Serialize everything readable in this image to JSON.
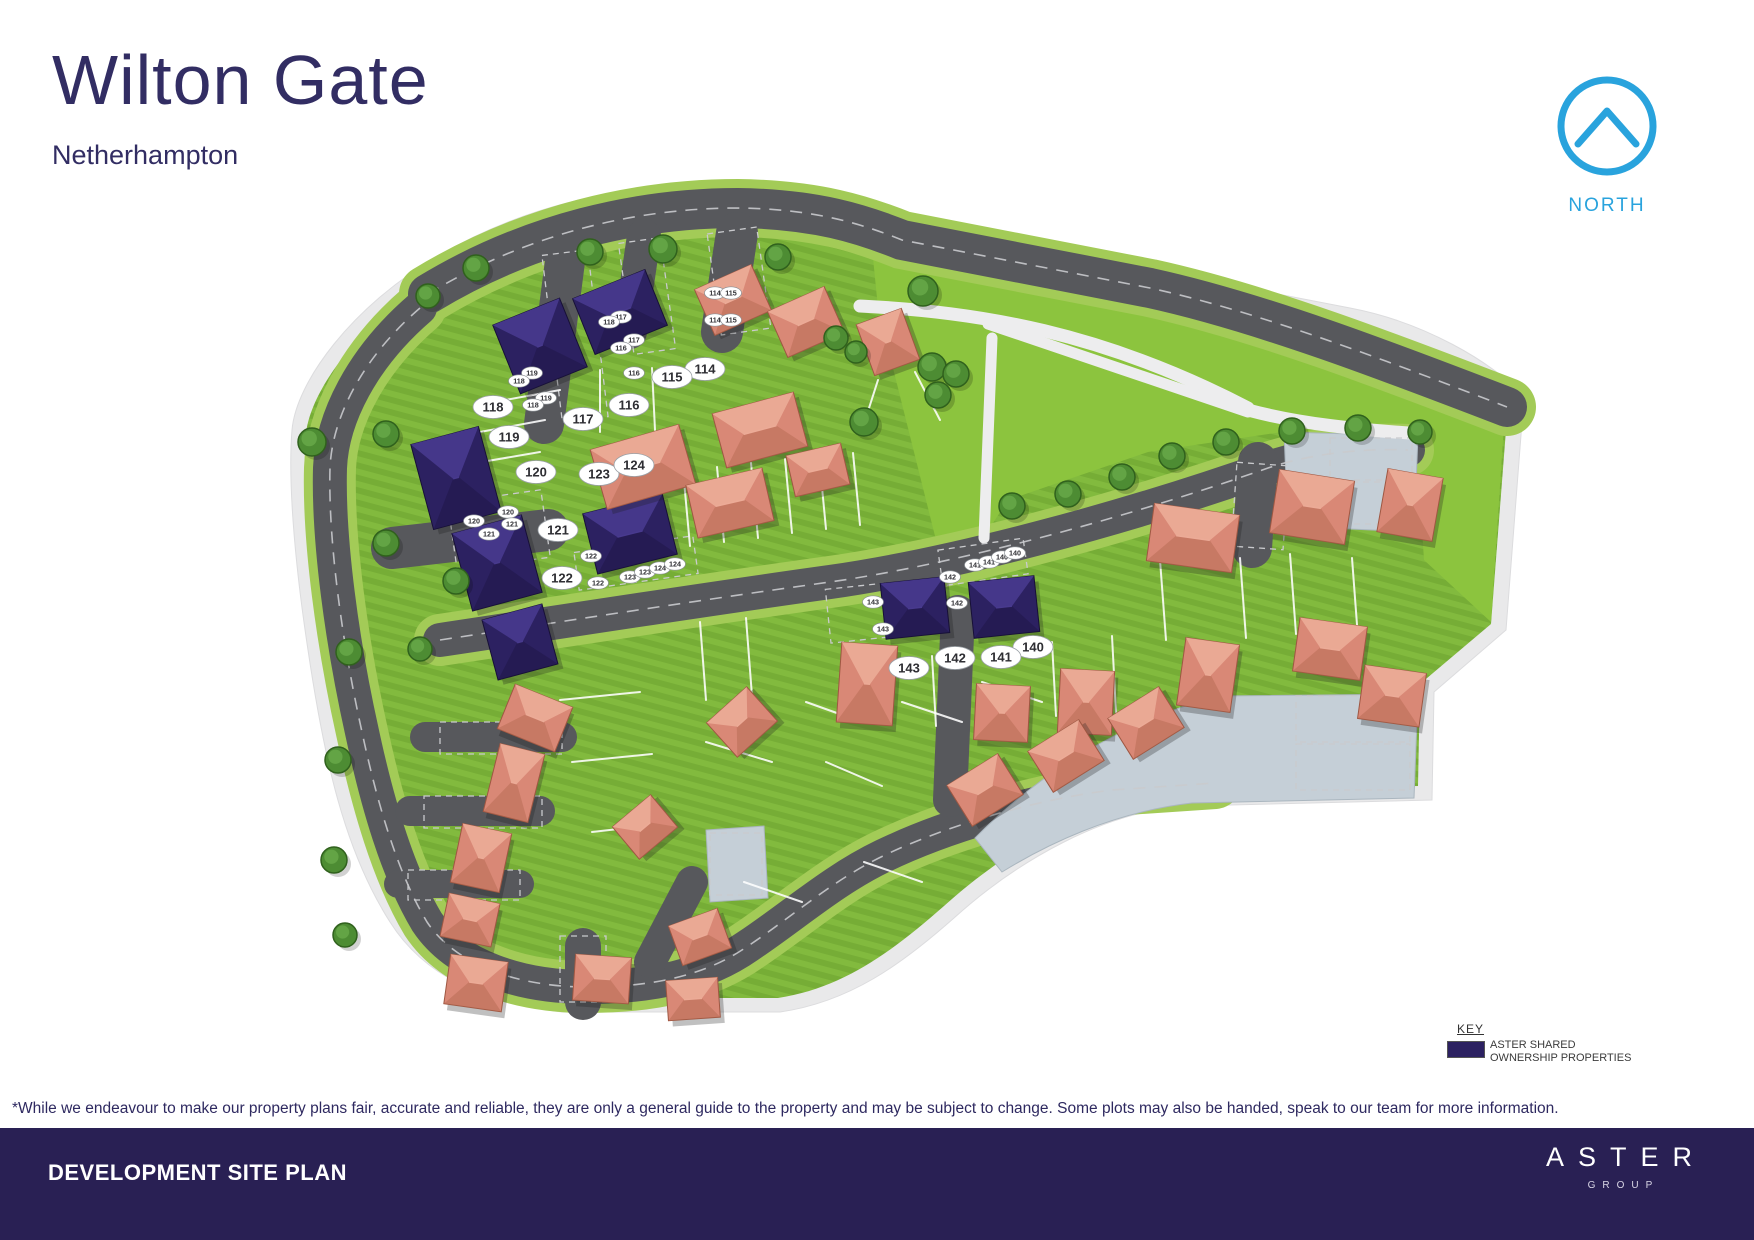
{
  "header": {
    "title": "Wilton Gate",
    "subtitle": "Netherhampton"
  },
  "north": {
    "label": "NORTH",
    "color": "#29a3dd"
  },
  "key": {
    "title": "KEY",
    "line1": "ASTER SHARED",
    "line2": "OWNERSHIP PROPERTIES",
    "swatch_color": "#2c2161"
  },
  "disclaimer": "*While we endeavour to make our property plans fair, accurate and reliable, they are only a general guide to the property and may be subject to change. Some plots may also be handed, speak to our team for more information.",
  "footer": {
    "title": "DEVELOPMENT SITE PLAN",
    "brand": "ASTER",
    "brand_sub": "GROUP"
  },
  "map": {
    "colors": {
      "band": "#e9e9ea",
      "band_line": "#dcdcde",
      "road": "#57585c",
      "verge": "#a3cb57",
      "dash": "#c9cacd",
      "paving": "#c5cfd7",
      "paving_line": "#aab6bf",
      "path": "#ededee",
      "grass_a": "#76ad36",
      "grass_b": "#82ba3e",
      "open": "#8cc43e",
      "shared": {
        "base": "#2c2161",
        "light": "#483a8e",
        "dark": "#1e1545",
        "line": "#171036"
      },
      "private": {
        "base": "#d98876",
        "light": "#ecab97",
        "dark": "#b66a52",
        "line": "#9e5742"
      },
      "tree": "#4d8c33",
      "tree_line": "#30611d",
      "tree_hi": "#66a647",
      "pill_text": "#2e2e33"
    },
    "site_outline": "M 438,256 C 520,208 612,186 700,186 C 780,187 836,200 884,218 L 1350,308 C 1424,322 1492,362 1524,396 L 1506,630 L 1434,692 L 1432,800 L 1190,806 C 1104,810 1016,862 954,918 C 902,964 850,1002 780,1012 L 562,1012 C 482,1002 424,976 390,922 C 344,850 324,758 308,650 C 294,558 288,478 292,430 C 296,382 352,306 438,256 Z",
    "inner_green": "M 452,268 C 528,222 616,200 700,200 C 776,201 830,214 878,232 L 1344,322 C 1412,335 1476,372 1508,404 L 1491,624 L 1420,684 L 1418,786 L 1188,792 C 1096,796 1008,848 944,906 C 894,950 844,988 778,998 L 566,998 C 492,989 434,964 402,914 C 358,844 338,754 322,648 C 308,556 302,480 306,434 C 310,390 364,314 452,268 Z",
    "open_space": "M 872,248 L 1348,336 L 1505,410 L 1491,622 L 1424,560 L 1416,436 L 1282,432 L 1148,452 L 1008,500 L 982,540 L 938,548 L 878,308 Z",
    "roads": [
      {
        "d": "M 428,294 C 530,232 640,208 738,208 C 816,209 862,224 902,240 L 1150,288 C 1260,312 1390,362 1507,407",
        "w": 40,
        "verge": true,
        "dash": true
      },
      {
        "d": "M 440,640 C 560,622 700,600 830,582 C 950,565 1120,520 1268,468 C 1310,454 1360,448 1408,450",
        "w": 34,
        "verge": true,
        "dash": true
      },
      {
        "d": "M 420,308 C 362,358 332,418 330,468 C 328,540 342,642 362,732 C 377,802 397,872 427,922 C 457,967 522,987 587,987 C 652,987 705,976 748,946 C 793,916 833,880 883,856 C 943,827 1032,800 1112,790 L 1215,783",
        "w": 34,
        "verge": true,
        "dash": true
      },
      {
        "d": "M 568,238 L 544,424",
        "w": 40
      },
      {
        "d": "M 644,236 L 630,332",
        "w": 34
      },
      {
        "d": "M 737,233 L 722,332",
        "w": 42
      },
      {
        "d": "M 392,548 L 548,530",
        "w": 42
      },
      {
        "d": "M 958,612 L 950,800",
        "w": 34
      },
      {
        "d": "M 650,962 L 692,882",
        "w": 32
      },
      {
        "d": "M 1258,462 L 1252,548",
        "w": 40
      },
      {
        "d": "M 425,737 L 562,737",
        "w": 30
      },
      {
        "d": "M 410,811 L 540,811",
        "w": 30
      },
      {
        "d": "M 398,884 L 520,884",
        "w": 28
      },
      {
        "d": "M 583,946 L 583,1002",
        "w": 36
      }
    ],
    "courts": [
      "M 1284,432 L 1418,436 L 1414,532 L 1288,526 Z",
      "M 975,838 C 1040,772 1122,722 1218,696 L 1418,694 L 1414,798 L 1192,803 C 1112,812 1044,846 1002,872 Z",
      "M 706,830 L 764,826 L 768,898 L 710,902 Z"
    ],
    "paths": [
      {
        "d": "M 860,306 C 980,312 1102,332 1248,408",
        "w": 13
      },
      {
        "d": "M 988,324 C 1070,352 1166,384 1248,412",
        "w": 11
      },
      {
        "d": "M 992,338 L 984,538",
        "w": 11
      },
      {
        "d": "M 1248,410 C 1300,424 1360,430 1424,434",
        "w": 13
      }
    ],
    "bays": [
      [
        552,
        252,
        46,
        168,
        -7
      ],
      [
        626,
        240,
        42,
        112,
        -8
      ],
      [
        714,
        230,
        50,
        102,
        -8
      ],
      [
        452,
        496,
        94,
        68,
        -8
      ],
      [
        440,
        722,
        122,
        32,
        0
      ],
      [
        424,
        796,
        118,
        32,
        0
      ],
      [
        408,
        870,
        112,
        30,
        0
      ],
      [
        560,
        936,
        46,
        66,
        0
      ],
      [
        576,
        544,
        120,
        38,
        -8
      ],
      [
        940,
        544,
        86,
        36,
        -8
      ],
      [
        828,
        586,
        62,
        54,
        -6
      ],
      [
        1234,
        464,
        52,
        84,
        4
      ],
      [
        1296,
        696,
        114,
        46,
        0
      ],
      [
        1296,
        744,
        114,
        46,
        0
      ],
      [
        1330,
        438,
        82,
        42,
        0
      ],
      [
        1330,
        482,
        82,
        42,
        0
      ],
      [
        710,
        833,
        52,
        62,
        0
      ]
    ],
    "fences": [
      [
        690,
        546,
        683,
        470
      ],
      [
        724,
        542,
        717,
        467
      ],
      [
        758,
        538,
        751,
        463
      ],
      [
        792,
        533,
        785,
        459
      ],
      [
        826,
        529,
        819,
        456
      ],
      [
        860,
        525,
        853,
        453
      ],
      [
        700,
        622,
        706,
        700
      ],
      [
        746,
        618,
        752,
        696
      ],
      [
        882,
        652,
        886,
        722
      ],
      [
        932,
        656,
        936,
        726
      ],
      [
        1052,
        642,
        1056,
        716
      ],
      [
        1112,
        636,
        1116,
        712
      ],
      [
        480,
        432,
        545,
        420
      ],
      [
        470,
        464,
        540,
        452
      ],
      [
        505,
        400,
        560,
        390
      ],
      [
        600,
        432,
        600,
        370
      ],
      [
        655,
        430,
        652,
        368
      ],
      [
        1160,
        560,
        1166,
        640
      ],
      [
        1240,
        558,
        1246,
        638
      ],
      [
        1290,
        554,
        1296,
        634
      ],
      [
        1352,
        558,
        1358,
        638
      ],
      [
        560,
        700,
        640,
        692
      ],
      [
        572,
        762,
        652,
        754
      ],
      [
        592,
        832,
        662,
        824
      ],
      [
        706,
        742,
        772,
        762
      ],
      [
        806,
        702,
        862,
        722
      ],
      [
        902,
        702,
        962,
        722
      ],
      [
        826,
        762,
        882,
        786
      ],
      [
        744,
        882,
        802,
        902
      ],
      [
        864,
        862,
        922,
        882
      ],
      [
        982,
        682,
        1042,
        702
      ],
      [
        878,
        380,
        862,
        430
      ],
      [
        915,
        372,
        940,
        420
      ]
    ],
    "houses": [
      {
        "x": 620,
        "y": 312,
        "w": 78,
        "h": 60,
        "r": -22,
        "t": "shared"
      },
      {
        "x": 540,
        "y": 346,
        "w": 72,
        "h": 74,
        "r": -22,
        "t": "shared"
      },
      {
        "x": 456,
        "y": 478,
        "w": 70,
        "h": 88,
        "r": -15,
        "t": "shared"
      },
      {
        "x": 497,
        "y": 563,
        "w": 72,
        "h": 80,
        "r": -15,
        "t": "shared"
      },
      {
        "x": 520,
        "y": 642,
        "w": 62,
        "h": 62,
        "r": -15,
        "t": "shared"
      },
      {
        "x": 630,
        "y": 534,
        "w": 82,
        "h": 62,
        "r": -14,
        "t": "shared"
      },
      {
        "x": 915,
        "y": 608,
        "w": 64,
        "h": 56,
        "r": -6,
        "t": "shared"
      },
      {
        "x": 1004,
        "y": 607,
        "w": 66,
        "h": 56,
        "r": -6,
        "t": "shared"
      },
      {
        "x": 733,
        "y": 300,
        "w": 62,
        "h": 50,
        "r": -24,
        "t": "private"
      },
      {
        "x": 806,
        "y": 322,
        "w": 62,
        "h": 50,
        "r": -24,
        "t": "private"
      },
      {
        "x": 888,
        "y": 342,
        "w": 48,
        "h": 54,
        "r": -20,
        "t": "private"
      },
      {
        "x": 643,
        "y": 467,
        "w": 92,
        "h": 62,
        "r": -16,
        "t": "private"
      },
      {
        "x": 760,
        "y": 430,
        "w": 84,
        "h": 56,
        "r": -15,
        "t": "private"
      },
      {
        "x": 730,
        "y": 503,
        "w": 78,
        "h": 54,
        "r": -13,
        "t": "private"
      },
      {
        "x": 818,
        "y": 470,
        "w": 56,
        "h": 42,
        "r": -13,
        "t": "private"
      },
      {
        "x": 1193,
        "y": 538,
        "w": 86,
        "h": 58,
        "r": 8,
        "t": "private"
      },
      {
        "x": 1312,
        "y": 507,
        "w": 76,
        "h": 64,
        "r": 9,
        "t": "private"
      },
      {
        "x": 1410,
        "y": 505,
        "w": 56,
        "h": 64,
        "r": 10,
        "t": "private"
      },
      {
        "x": 1208,
        "y": 675,
        "w": 54,
        "h": 68,
        "r": 8,
        "t": "private"
      },
      {
        "x": 1330,
        "y": 649,
        "w": 68,
        "h": 54,
        "r": 8,
        "t": "private"
      },
      {
        "x": 1392,
        "y": 696,
        "w": 62,
        "h": 54,
        "r": 8,
        "t": "private"
      },
      {
        "x": 867,
        "y": 684,
        "w": 56,
        "h": 80,
        "r": 4,
        "t": "private"
      },
      {
        "x": 1002,
        "y": 713,
        "w": 54,
        "h": 56,
        "r": 3,
        "t": "private"
      },
      {
        "x": 1086,
        "y": 702,
        "w": 54,
        "h": 64,
        "r": 3,
        "t": "private"
      },
      {
        "x": 985,
        "y": 790,
        "w": 60,
        "h": 48,
        "r": -32,
        "t": "private"
      },
      {
        "x": 1066,
        "y": 756,
        "w": 60,
        "h": 48,
        "r": -32,
        "t": "private"
      },
      {
        "x": 1146,
        "y": 723,
        "w": 60,
        "h": 48,
        "r": -32,
        "t": "private"
      },
      {
        "x": 535,
        "y": 718,
        "w": 62,
        "h": 48,
        "r": 22,
        "t": "private"
      },
      {
        "x": 514,
        "y": 783,
        "w": 46,
        "h": 70,
        "r": 14,
        "t": "private"
      },
      {
        "x": 481,
        "y": 858,
        "w": 50,
        "h": 60,
        "r": 12,
        "t": "private"
      },
      {
        "x": 470,
        "y": 920,
        "w": 52,
        "h": 44,
        "r": 12,
        "t": "private"
      },
      {
        "x": 476,
        "y": 983,
        "w": 58,
        "h": 50,
        "r": 8,
        "t": "private"
      },
      {
        "x": 602,
        "y": 979,
        "w": 56,
        "h": 46,
        "r": 4,
        "t": "private"
      },
      {
        "x": 693,
        "y": 999,
        "w": 52,
        "h": 40,
        "r": -4,
        "t": "private"
      },
      {
        "x": 645,
        "y": 827,
        "w": 50,
        "h": 42,
        "r": -40,
        "t": "private"
      },
      {
        "x": 742,
        "y": 722,
        "w": 54,
        "h": 46,
        "r": -42,
        "t": "private"
      },
      {
        "x": 700,
        "y": 937,
        "w": 52,
        "h": 42,
        "r": -20,
        "t": "private"
      }
    ],
    "trees": [
      [
        476,
        268,
        13
      ],
      [
        590,
        252,
        13
      ],
      [
        663,
        249,
        14
      ],
      [
        778,
        257,
        13
      ],
      [
        428,
        296,
        12
      ],
      [
        923,
        291,
        15
      ],
      [
        932,
        367,
        14
      ],
      [
        956,
        374,
        13
      ],
      [
        938,
        395,
        13
      ],
      [
        864,
        422,
        14
      ],
      [
        836,
        338,
        12
      ],
      [
        856,
        352,
        11
      ],
      [
        1012,
        506,
        13
      ],
      [
        1068,
        494,
        13
      ],
      [
        1122,
        477,
        13
      ],
      [
        1172,
        456,
        13
      ],
      [
        1226,
        442,
        13
      ],
      [
        1292,
        431,
        13
      ],
      [
        1358,
        428,
        13
      ],
      [
        1420,
        432,
        12
      ],
      [
        312,
        442,
        14
      ],
      [
        386,
        434,
        13
      ],
      [
        386,
        543,
        13
      ],
      [
        456,
        581,
        13
      ],
      [
        420,
        649,
        12
      ],
      [
        349,
        652,
        13
      ],
      [
        338,
        760,
        13
      ],
      [
        334,
        860,
        13
      ],
      [
        345,
        935,
        12
      ]
    ],
    "plot_labels": [
      {
        "n": "114",
        "x": 705,
        "y": 369
      },
      {
        "n": "115",
        "x": 672,
        "y": 377
      },
      {
        "n": "116",
        "x": 629,
        "y": 405
      },
      {
        "n": "117",
        "x": 583,
        "y": 419
      },
      {
        "n": "118",
        "x": 493,
        "y": 407
      },
      {
        "n": "119",
        "x": 509,
        "y": 437
      },
      {
        "n": "120",
        "x": 536,
        "y": 472
      },
      {
        "n": "121",
        "x": 558,
        "y": 530
      },
      {
        "n": "122",
        "x": 562,
        "y": 578
      },
      {
        "n": "123",
        "x": 599,
        "y": 474
      },
      {
        "n": "124",
        "x": 634,
        "y": 465
      },
      {
        "n": "140",
        "x": 1033,
        "y": 647
      },
      {
        "n": "141",
        "x": 1001,
        "y": 657
      },
      {
        "n": "142",
        "x": 955,
        "y": 658
      },
      {
        "n": "143",
        "x": 909,
        "y": 668
      }
    ],
    "bay_labels": [
      {
        "n": "114",
        "x": 715,
        "y": 293
      },
      {
        "n": "115",
        "x": 731,
        "y": 293
      },
      {
        "n": "114",
        "x": 715,
        "y": 320
      },
      {
        "n": "115",
        "x": 731,
        "y": 320
      },
      {
        "n": "117",
        "x": 621,
        "y": 317
      },
      {
        "n": "118",
        "x": 609,
        "y": 322
      },
      {
        "n": "117",
        "x": 634,
        "y": 340
      },
      {
        "n": "116",
        "x": 621,
        "y": 348
      },
      {
        "n": "116",
        "x": 634,
        "y": 373
      },
      {
        "n": "119",
        "x": 532,
        "y": 373
      },
      {
        "n": "118",
        "x": 519,
        "y": 381
      },
      {
        "n": "119",
        "x": 546,
        "y": 398
      },
      {
        "n": "118",
        "x": 533,
        "y": 405
      },
      {
        "n": "120",
        "x": 508,
        "y": 512
      },
      {
        "n": "120",
        "x": 474,
        "y": 521
      },
      {
        "n": "121",
        "x": 512,
        "y": 524
      },
      {
        "n": "121",
        "x": 489,
        "y": 534
      },
      {
        "n": "122",
        "x": 591,
        "y": 556
      },
      {
        "n": "122",
        "x": 598,
        "y": 583
      },
      {
        "n": "123",
        "x": 630,
        "y": 577
      },
      {
        "n": "123",
        "x": 645,
        "y": 572
      },
      {
        "n": "124",
        "x": 660,
        "y": 568
      },
      {
        "n": "124",
        "x": 675,
        "y": 564
      },
      {
        "n": "143",
        "x": 873,
        "y": 602
      },
      {
        "n": "143",
        "x": 883,
        "y": 629
      },
      {
        "n": "142",
        "x": 950,
        "y": 577
      },
      {
        "n": "142",
        "x": 957,
        "y": 603
      },
      {
        "n": "141",
        "x": 975,
        "y": 565
      },
      {
        "n": "141",
        "x": 989,
        "y": 562
      },
      {
        "n": "140",
        "x": 1002,
        "y": 557
      },
      {
        "n": "140",
        "x": 1015,
        "y": 553
      }
    ]
  }
}
